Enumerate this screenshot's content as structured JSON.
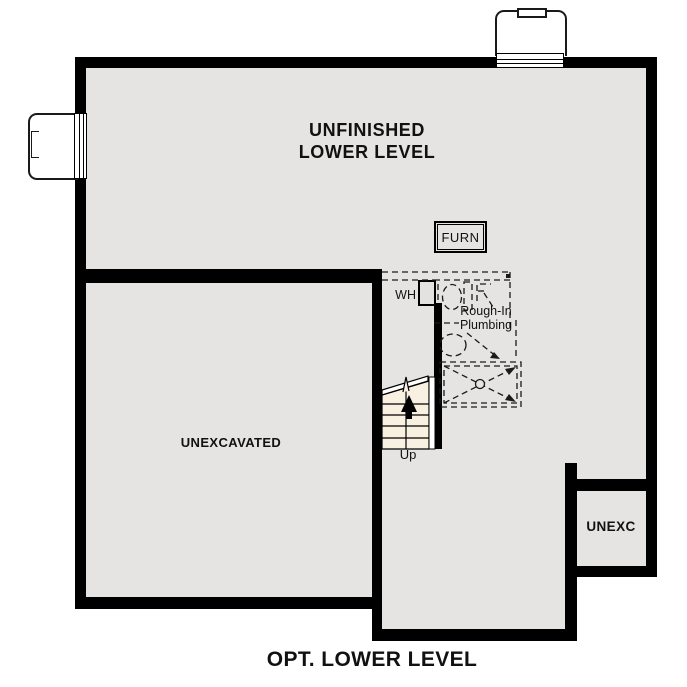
{
  "plan_title": "OPT. LOWER LEVEL",
  "rooms": {
    "unfinished_lower_level": {
      "line1": "UNFINISHED",
      "line2": "LOWER LEVEL"
    },
    "unexcavated": {
      "label": "UNEXCAVATED"
    },
    "unexc": {
      "label": "UNEXC"
    }
  },
  "labels": {
    "furnace": "FURN",
    "water_heater": "WH",
    "rough_in_line1": "Rough-In",
    "rough_in_line2": "Plumbing",
    "stairs_up": "Up"
  },
  "colors": {
    "wall": "#000000",
    "floor_fill": "#e5e4e2",
    "stair_fill": "#f8f1e2",
    "background": "#ffffff",
    "linework": "#1a1a1a"
  }
}
